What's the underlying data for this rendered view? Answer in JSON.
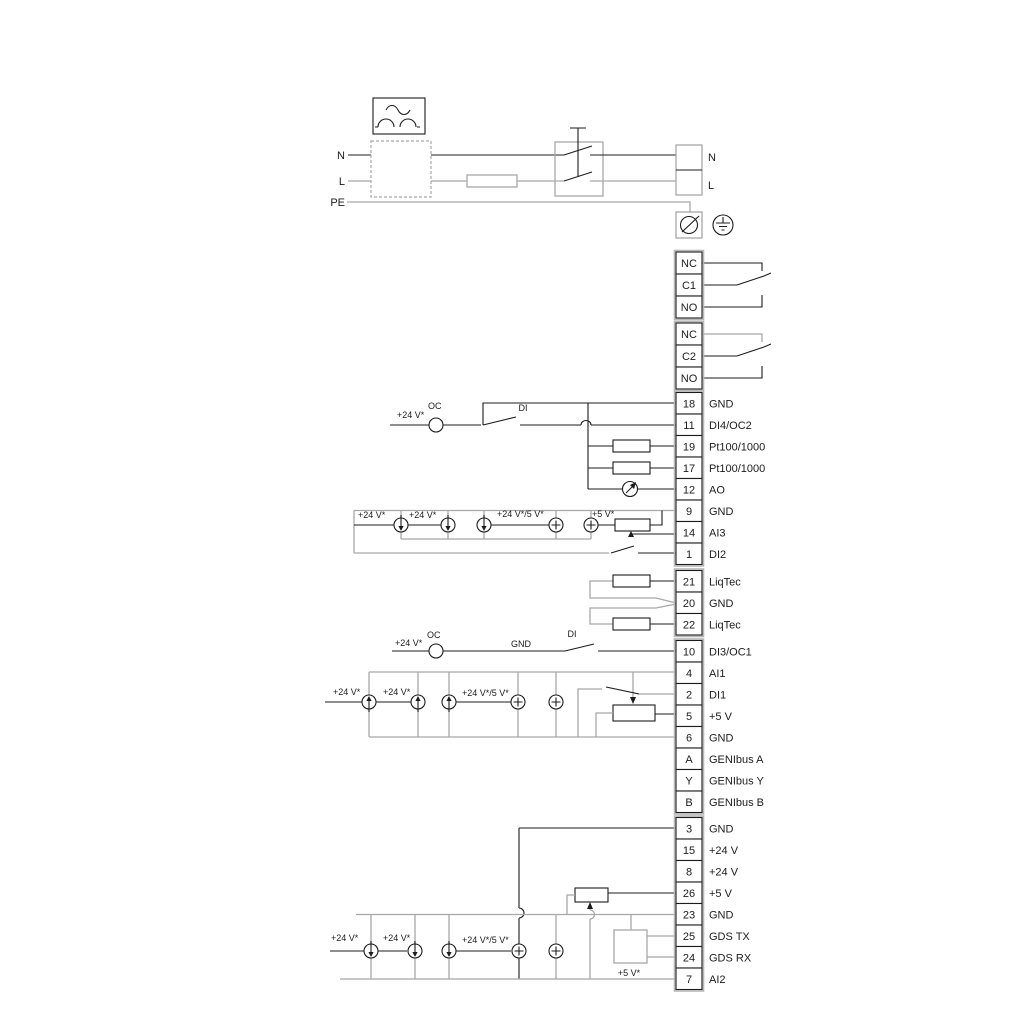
{
  "supply": {
    "left": [
      "N",
      "L",
      "PE"
    ],
    "right": [
      "N",
      "L"
    ]
  },
  "relays": [
    [
      "NC",
      "C1",
      "NO"
    ],
    [
      "NC",
      "C2",
      "NO"
    ]
  ],
  "terminal_groups": {
    "a": [
      {
        "pin": "18",
        "label": "GND"
      },
      {
        "pin": "11",
        "label": "DI4/OC2"
      },
      {
        "pin": "19",
        "label": "Pt100/1000"
      },
      {
        "pin": "17",
        "label": "Pt100/1000"
      },
      {
        "pin": "12",
        "label": "AO"
      },
      {
        "pin": "9",
        "label": "GND"
      },
      {
        "pin": "14",
        "label": "AI3"
      },
      {
        "pin": "1",
        "label": "DI2"
      }
    ],
    "b": [
      {
        "pin": "21",
        "label": "LiqTec"
      },
      {
        "pin": "20",
        "label": "GND"
      },
      {
        "pin": "22",
        "label": "LiqTec"
      }
    ],
    "c": [
      {
        "pin": "10",
        "label": "DI3/OC1"
      },
      {
        "pin": "4",
        "label": "AI1"
      },
      {
        "pin": "2",
        "label": "DI1"
      },
      {
        "pin": "5",
        "label": "+5 V"
      },
      {
        "pin": "6",
        "label": "GND"
      },
      {
        "pin": "A",
        "label": "GENIbus A"
      },
      {
        "pin": "Y",
        "label": "GENIbus Y"
      },
      {
        "pin": "B",
        "label": "GENIbus B"
      }
    ],
    "d": [
      {
        "pin": "3",
        "label": "GND"
      },
      {
        "pin": "15",
        "label": "+24 V"
      },
      {
        "pin": "8",
        "label": "+24 V"
      },
      {
        "pin": "26",
        "label": "+5 V"
      },
      {
        "pin": "23",
        "label": "GND"
      },
      {
        "pin": "25",
        "label": "GDS TX"
      },
      {
        "pin": "24",
        "label": "GDS RX"
      },
      {
        "pin": "7",
        "label": "AI2"
      }
    ]
  },
  "ann": {
    "p24": "+24 V*",
    "p24_5": "+24 V*/5 V*",
    "p5": "+5 V*",
    "oc": "OC",
    "di": "DI",
    "gnd": "GND"
  },
  "colors": {
    "wire_dark": "#1c1c1c",
    "wire_gray": "#a8a8a8",
    "background": "#ffffff"
  }
}
